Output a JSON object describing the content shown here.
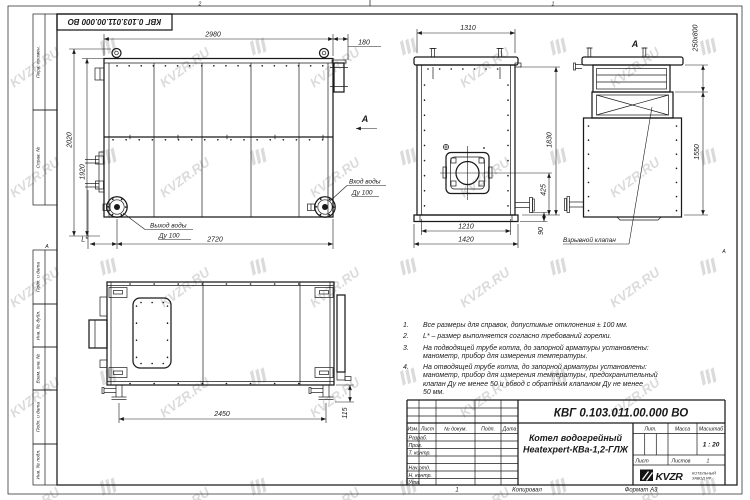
{
  "watermark": {
    "text": "KVZR.RU"
  },
  "frame": {
    "zone_top_left": "2",
    "zone_top_right": "1",
    "zone_bottom": "1",
    "zone_side_left": "А",
    "zone_side_right": "А",
    "stamp": "КВГ 0.103.011.00.000 ВО",
    "left_fields": [
      {
        "label": "Перв. примен."
      },
      {
        "label": "Справ. №"
      },
      {
        "label": "Подп. и дата"
      },
      {
        "label": "Инв. № дубл."
      },
      {
        "label": "Взам. инв. №"
      },
      {
        "label": "Подп. и дата"
      },
      {
        "label": "Инв. № подл."
      }
    ]
  },
  "front_view": {
    "dim_2980": "2980",
    "dim_180": "180",
    "dim_2020": "2020",
    "dim_1920": "1920",
    "dim_2720": "2720",
    "dim_L": "L*",
    "inlet_label": "Вход воды",
    "inlet_size": "Ду 100",
    "outlet_label": "Выход воды",
    "outlet_size": "Ду 100",
    "arrow_label": "А"
  },
  "side_view": {
    "dim_1310": "1310",
    "dim_1830": "1830",
    "dim_425": "425",
    "dim_90": "90",
    "dim_1210": "1210",
    "dim_1420": "1420"
  },
  "view_a": {
    "label": "А",
    "dim_duct": "250x800",
    "dim_1550": "1550",
    "valve_callout": "Взрывной клапан"
  },
  "top_view": {
    "dim_2450": "2450",
    "dim_115": "115"
  },
  "notes": {
    "items": [
      {
        "num": "1.",
        "lines": [
          "Все размеры для справок, допустимые отклонения ± 100 мм."
        ]
      },
      {
        "num": "2.",
        "lines": [
          "L* – размер выполняется согласно требований горелки."
        ]
      },
      {
        "num": "3.",
        "lines": [
          "На подводящей трубе котла, до запорной арматуры установлены:",
          "манометр, прибор для измерения температуры."
        ]
      },
      {
        "num": "4.",
        "lines": [
          "На отводящей трубе котла, до запорной арматуры установлены:",
          "манометр, прибор для измерения температуры, предохранительный",
          "клапан Ду не менее 50 и обвод с обратным клапаном Ду не менее",
          "50 мм."
        ]
      }
    ]
  },
  "title_block": {
    "doc_number": "КВГ 0.103.011.00.000 ВО",
    "product_line1": "Котел водогрейный",
    "product_line2": "Heatexpert-КВа-1,2-ГЛЖ",
    "col_izm": "Изм.",
    "col_list": "Лист",
    "col_doc": "№ докум.",
    "col_sign": "Подп.",
    "col_date": "Дата",
    "row_razrab": "Разраб.",
    "row_prov": "Пров.",
    "row_tkontr": "Т. контр.",
    "row_nachotd": "Нач.отд.",
    "row_nkontr": "Н. контр.",
    "row_utv": "Утв.",
    "lit_label": "Лит.",
    "mass_label": "Масса",
    "scale_label": "Масштаб",
    "scale_value": "1 : 20",
    "sheet_label": "Лист",
    "sheets_label": "Листов",
    "sheets_value": "1",
    "logo_text": "KVZR",
    "logo_sub_line1": "КОТЕЛЬНЫЙ",
    "logo_sub_line2": "ЗАВОД РФ",
    "footer_zone": "1",
    "footer_copy": "Копировал",
    "footer_format": "Формат А3"
  }
}
